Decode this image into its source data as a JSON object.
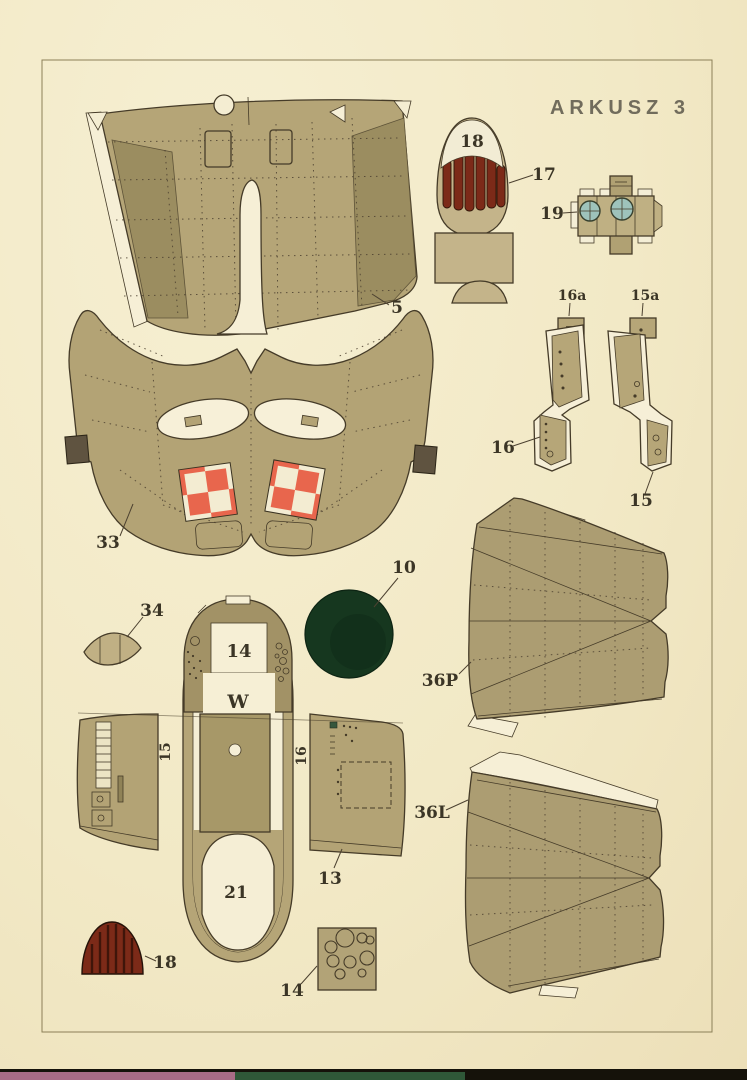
{
  "sheet": {
    "title": "ARKUSZ 3"
  },
  "part_labels": {
    "p5": "5",
    "p10": "10",
    "p13": "13",
    "p14_deck": "14",
    "p14_plate": "14",
    "p15_strip": "15",
    "p15a": "15a",
    "p15_cockpit": "15",
    "p16_strip": "16",
    "p16a": "16a",
    "p16_cockpit": "16",
    "p17": "17",
    "p18_cowl": "18",
    "p18_plug": "18",
    "p19": "19",
    "p21": "21",
    "p33": "33",
    "p34": "34",
    "p36P": "36P",
    "p36L": "36L",
    "w_marking": "W"
  },
  "colors": {
    "paper": "#f2e9c6",
    "paper_white": "#f6efd6",
    "part_tan": "#b5a577",
    "part_tan_dark": "#9b8d60",
    "outline": "#453b28",
    "cowl_red": "#7c2a18",
    "cowl_stripe_dark": "#54190c",
    "insignia_red": "#e8664d",
    "headrest_green": "#16371f",
    "wheel_blue": "#9ec3bb",
    "edge_strip_pink": "#a86c86",
    "edge_strip_green": "#2f5838",
    "edge_strip_black": "#15120a"
  }
}
